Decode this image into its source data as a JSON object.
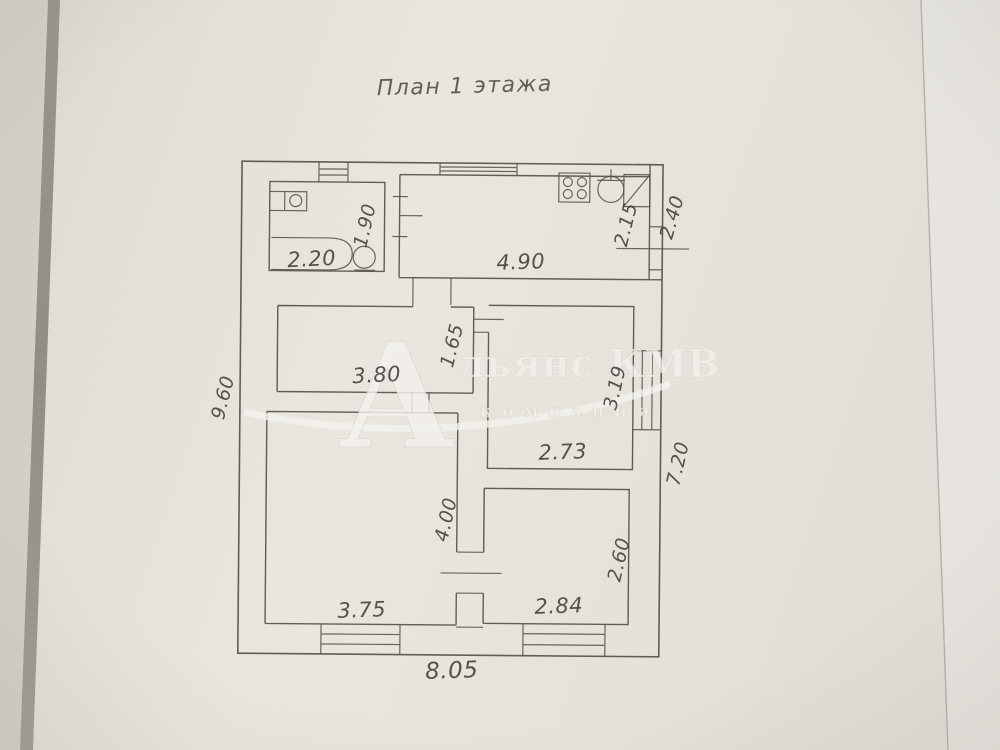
{
  "document": {
    "title": "План 1 этажа"
  },
  "watermark": {
    "initial": "А",
    "company_rest": "льянс КМВ",
    "subtitle": "компания"
  },
  "dimensions": {
    "bathroom_width": "2.20",
    "bathroom_depth": "1.90",
    "kitchen_width": "4.90",
    "kitchen_inner_depth": "2.15",
    "top_right_exterior": "2.40",
    "hall_room_width": "3.80",
    "hall_room_depth": "1.65",
    "room_right_width": "2.73",
    "room_right_depth": "3.19",
    "left_exterior": "9.60",
    "right_exterior": "7.20",
    "room_left_depth": "4.00",
    "room_bottom_right_depth": "2.60",
    "room_left_width": "3.75",
    "room_bottom_right_width": "2.84",
    "bottom_exterior": "8.05"
  }
}
